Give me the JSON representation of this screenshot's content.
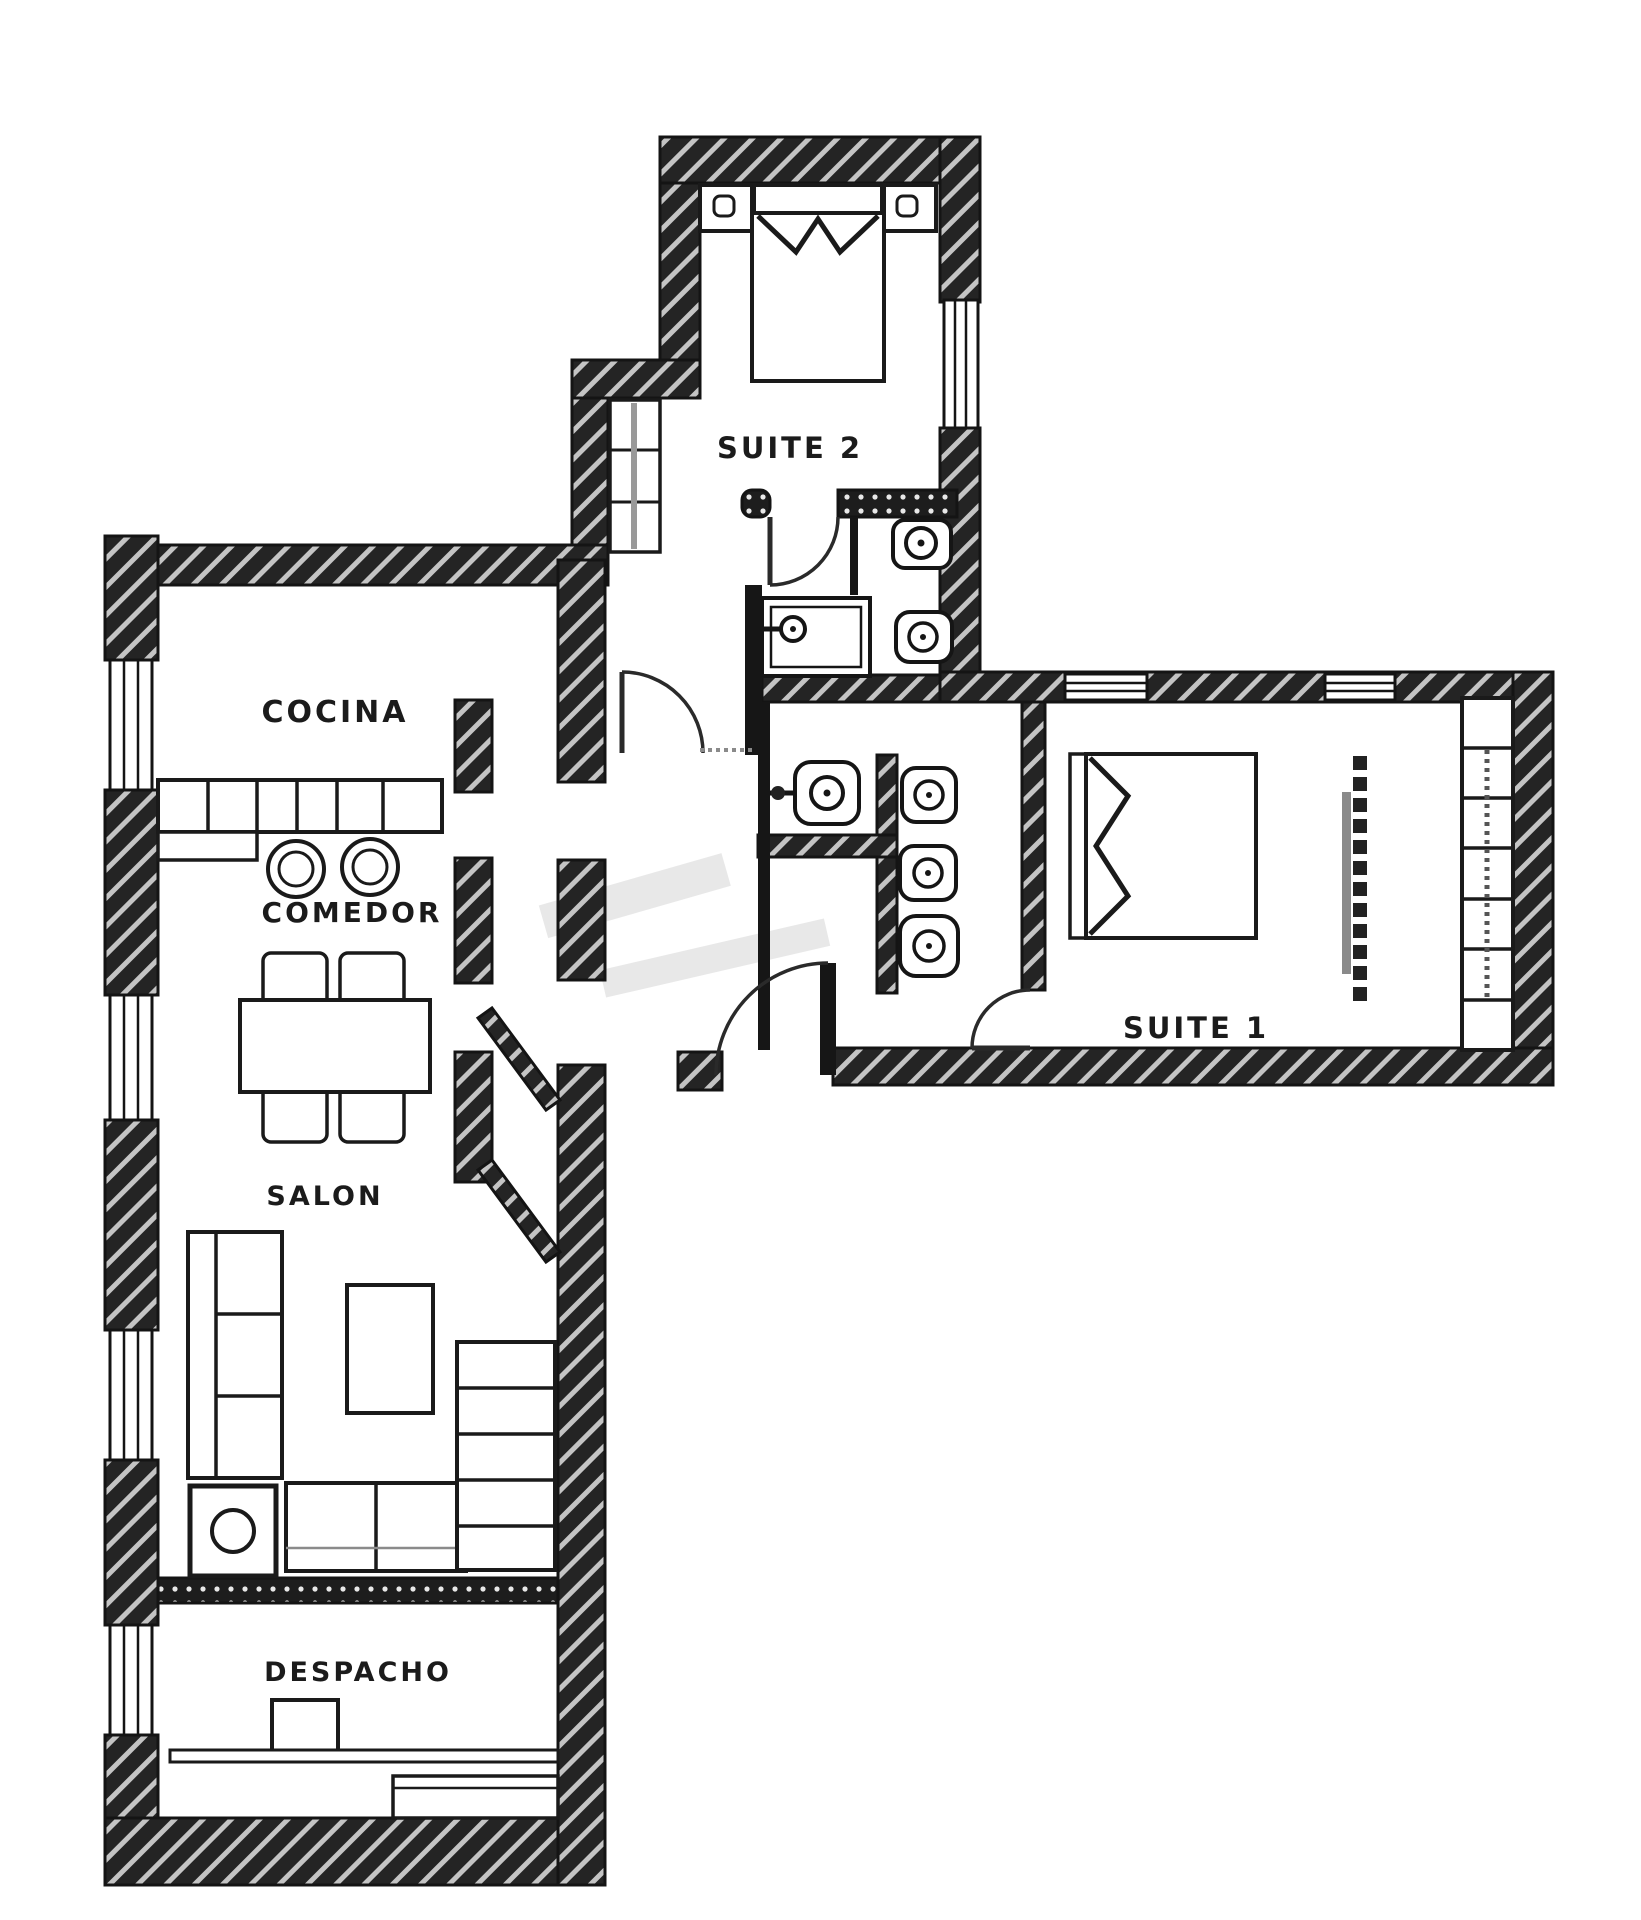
{
  "floor_plan": {
    "background": "#ffffff",
    "wall_fill": "#242424",
    "wall_stripe": "#c4c4c4",
    "line_color": "#161616",
    "rooms": [
      {
        "id": "cocina",
        "label": "COCINA"
      },
      {
        "id": "comedor",
        "label": "COMEDOR"
      },
      {
        "id": "salon",
        "label": "SALON"
      },
      {
        "id": "despacho",
        "label": "DESPACHO"
      },
      {
        "id": "suite1",
        "label": "SUITE 1"
      },
      {
        "id": "suite2",
        "label": "SUITE 2"
      }
    ]
  }
}
